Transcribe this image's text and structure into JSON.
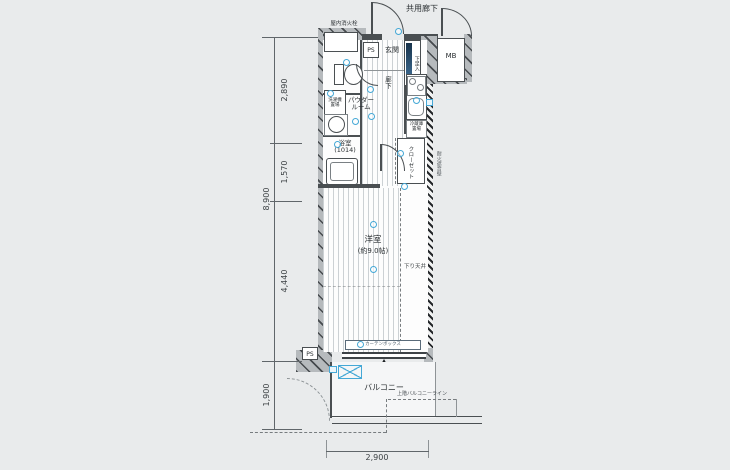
{
  "colors": {
    "bg": "#e9ebec",
    "wall_fill": "#b6babd",
    "line": "#4a4f52",
    "symbol_blue": "#45a8d6"
  },
  "labels": {
    "common_corridor": "共用廊下",
    "fire_hydrant": "屋内消火栓",
    "ps_top": "PS",
    "entrance": "玄関",
    "shoe_cabinet": "下足入",
    "meter_box": "MB",
    "hallway": "廊下",
    "powder_room_l1": "パウダー",
    "powder_room_l2": "ルーム",
    "washer_l1": "洗濯機",
    "washer_l2": "置場",
    "bathroom_l1": "浴室",
    "bathroom_l2": "(1014)",
    "fridge_l1": "冷蔵庫",
    "fridge_l2": "置場",
    "closet": "クローゼット",
    "fire_sound_wall": "耐火遮音壁",
    "western_room_l1": "洋室",
    "western_room_l2": "(約9.0帖)",
    "lowered_ceiling": "下り天井",
    "curtain_box": "カーテンボックス",
    "balcony": "バルコニー",
    "upper_balcony_line": "上階バルコニーライン",
    "ps_bottom": "PS"
  },
  "dimensions": {
    "left_top": "2,890",
    "left_mid": "1,570",
    "left_bottom": "4,440",
    "left_total": "8,900",
    "balcony_depth": "1,900",
    "bottom_width": "2,900"
  },
  "symbols": [
    {
      "name": "fixture-symbol",
      "kind": "circle",
      "x": 343,
      "y": 59,
      "w": 7,
      "h": 7
    },
    {
      "name": "fixture-symbol",
      "kind": "circle",
      "x": 327,
      "y": 90,
      "w": 7,
      "h": 7
    },
    {
      "name": "fixture-symbol",
      "kind": "circle",
      "x": 352,
      "y": 118,
      "w": 7,
      "h": 7
    },
    {
      "name": "fixture-symbol",
      "kind": "circle",
      "x": 334,
      "y": 141,
      "w": 7,
      "h": 7
    },
    {
      "name": "fixture-symbol",
      "kind": "circle",
      "x": 367,
      "y": 86,
      "w": 7,
      "h": 7
    },
    {
      "name": "fixture-symbol",
      "kind": "circle",
      "x": 368,
      "y": 113,
      "w": 7,
      "h": 7
    },
    {
      "name": "fixture-symbol",
      "kind": "circle",
      "x": 395,
      "y": 28,
      "w": 7,
      "h": 7
    },
    {
      "name": "fixture-symbol",
      "kind": "circle",
      "x": 413,
      "y": 97,
      "w": 7,
      "h": 7
    },
    {
      "name": "fixture-symbol",
      "kind": "circle",
      "x": 397,
      "y": 150,
      "w": 7,
      "h": 7
    },
    {
      "name": "fixture-symbol",
      "kind": "circle",
      "x": 401,
      "y": 183,
      "w": 7,
      "h": 7
    },
    {
      "name": "fixture-symbol",
      "kind": "circle",
      "x": 370,
      "y": 221,
      "w": 7,
      "h": 7
    },
    {
      "name": "fixture-symbol",
      "kind": "circle",
      "x": 370,
      "y": 266,
      "w": 7,
      "h": 7
    },
    {
      "name": "fixture-symbol",
      "kind": "circle",
      "x": 357,
      "y": 341,
      "w": 7,
      "h": 7
    },
    {
      "name": "fixture-symbol",
      "kind": "square",
      "x": 426,
      "y": 99,
      "w": 7,
      "h": 7
    },
    {
      "name": "fixture-symbol",
      "kind": "square",
      "x": 329,
      "y": 366,
      "w": 8,
      "h": 7
    }
  ]
}
